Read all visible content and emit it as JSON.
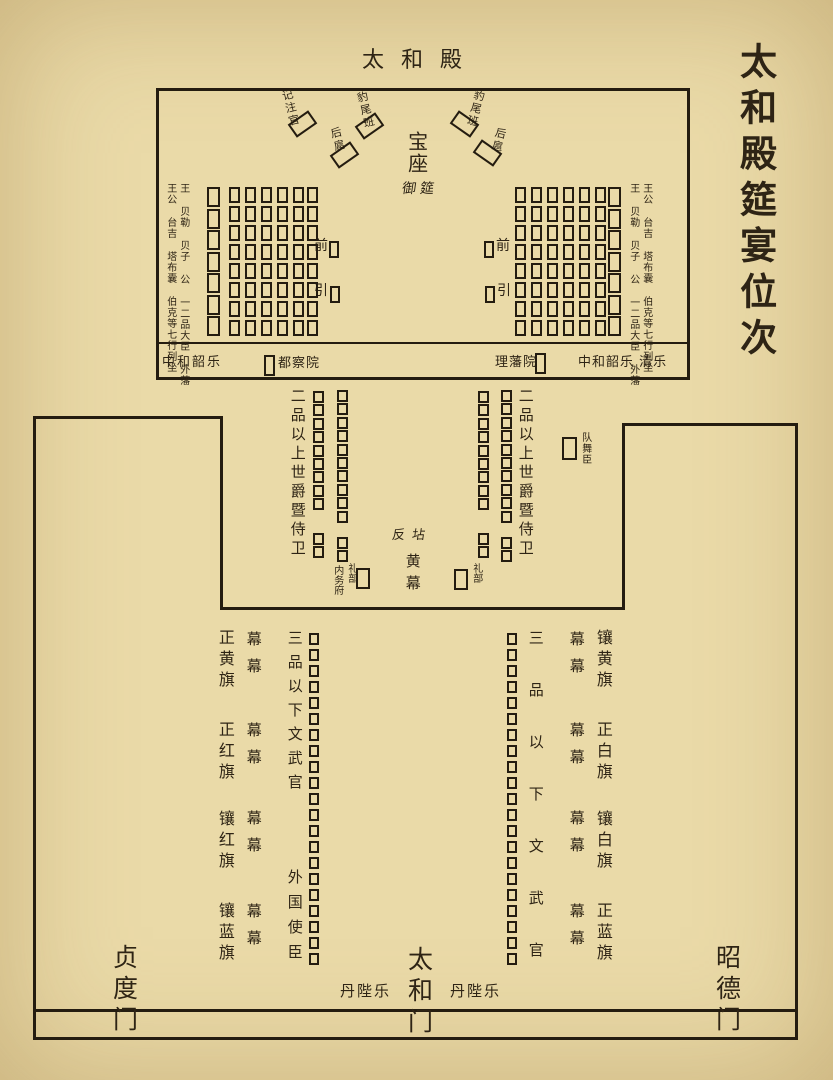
{
  "title": "太和殿筵宴位次",
  "hall": {
    "name": "太和殿",
    "throne": "宝座",
    "imperial_banquet": "御筵",
    "recorder": "记注官",
    "leopard_tail_left": "豹尾班",
    "leopard_tail_right": "豹尾班",
    "rear_escort_left": "后扈",
    "rear_escort_right": "后扈",
    "front_left": "前",
    "guide_left": "引",
    "front_right": "前",
    "guide_right": "引",
    "left_outer_label": "王公 台吉 塔布囊 伯克等七行列坐",
    "left_inner_label": "王 贝勒 贝子 公 一二品大臣 外藩",
    "right_inner_label": "王 贝勒 贝子 公 一二品大臣 外藩",
    "right_outer_label": "王公 台吉 塔布囊 伯克等七行列坐",
    "strip": {
      "music_left": "中和韶乐",
      "censorate": "都察院",
      "court_of_dependencies": "理藩院",
      "music_right": "中和韶乐 清乐"
    }
  },
  "terrace": {
    "left_label": "二品以上世爵暨侍卫",
    "right_label": "二品以上世爵暨侍卫",
    "dance_troupe": "队舞臣",
    "fandian": "反坫",
    "yellow_tent": "黄幕",
    "imperial_household_dept": "内务府",
    "rites_left": "礼部",
    "rites_right": "礼部"
  },
  "courtyard": {
    "left_banners": [
      "正黄旗",
      "正红旗",
      "镶红旗",
      "镶蓝旗"
    ],
    "right_banners": [
      "镶黄旗",
      "正白旗",
      "镶白旗",
      "正蓝旗"
    ],
    "tent_pair": "幕幕",
    "left_officials": "三品以下文武官",
    "foreign_envoys": "外国使臣",
    "right_officials": "三品以下文武官",
    "music_left": "丹陛乐",
    "music_right": "丹陛乐"
  },
  "gates": {
    "west": "贞度门",
    "center": "太和门",
    "east": "昭德门"
  },
  "colors": {
    "background": "#eadaa8",
    "ink": "#2e2415",
    "line": "#241c10"
  },
  "seats": [
    {
      "name": "recorder-seat",
      "x": 290,
      "y": 116,
      "w": 25,
      "h": 16,
      "rot": -35,
      "count": 1
    },
    {
      "name": "leopard-tail-seat-left",
      "x": 357,
      "y": 118,
      "w": 25,
      "h": 16,
      "rot": -35,
      "count": 1
    },
    {
      "name": "rear-escort-seat-left",
      "x": 332,
      "y": 147,
      "w": 25,
      "h": 16,
      "rot": -35,
      "count": 1
    },
    {
      "name": "leopard-tail-seat-right",
      "x": 452,
      "y": 116,
      "w": 25,
      "h": 16,
      "rot": 35,
      "count": 1
    },
    {
      "name": "rear-escort-seat-right",
      "x": 475,
      "y": 145,
      "w": 25,
      "h": 16,
      "rot": 35,
      "count": 1
    },
    {
      "name": "princes-column-left",
      "x": 207,
      "y": 187,
      "w": 13,
      "h": 20,
      "pitch": 21.5,
      "count": 7
    },
    {
      "name": "nobles-grid-left",
      "cols": [
        229,
        245,
        261,
        277,
        293,
        307
      ],
      "y": 187,
      "w": 11,
      "h": 16,
      "pitch": 19,
      "count": 8
    },
    {
      "name": "nobles-grid-right",
      "cols": [
        515,
        531,
        547,
        563,
        579,
        595
      ],
      "y": 187,
      "w": 11,
      "h": 16,
      "pitch": 19,
      "count": 8
    },
    {
      "name": "princes-column-right",
      "x": 608,
      "y": 187,
      "w": 13,
      "h": 20,
      "pitch": 21.5,
      "count": 7
    },
    {
      "name": "front-guide-seat-left",
      "x": 329,
      "y": 241,
      "w": 10,
      "h": 17,
      "count": 1
    },
    {
      "name": "front-guide-seat-left",
      "x": 330,
      "y": 286,
      "w": 10,
      "h": 17,
      "count": 1
    },
    {
      "name": "front-guide-seat-right",
      "x": 484,
      "y": 241,
      "w": 10,
      "h": 17,
      "count": 1
    },
    {
      "name": "front-guide-seat-right",
      "x": 485,
      "y": 286,
      "w": 10,
      "h": 17,
      "count": 1
    },
    {
      "name": "censorate-seat",
      "x": 264,
      "y": 355,
      "w": 11,
      "h": 21,
      "count": 1
    },
    {
      "name": "dependencies-court-seat",
      "x": 535,
      "y": 353,
      "w": 11,
      "h": 21,
      "count": 1
    },
    {
      "name": "guard-column-left",
      "x": 313,
      "y": 391,
      "w": 11,
      "h": 12,
      "pitch": 13.4,
      "groups": [
        9,
        2
      ],
      "gap": 21
    },
    {
      "name": "guard-column-left",
      "x": 337,
      "y": 390,
      "w": 11,
      "h": 12,
      "pitch": 13.4,
      "groups": [
        10,
        2
      ],
      "gap": 13
    },
    {
      "name": "guard-column-right",
      "x": 478,
      "y": 391,
      "w": 11,
      "h": 12,
      "pitch": 13.4,
      "groups": [
        9,
        2
      ],
      "gap": 21
    },
    {
      "name": "guard-column-right",
      "x": 501,
      "y": 390,
      "w": 11,
      "h": 12,
      "pitch": 13.4,
      "groups": [
        10,
        2
      ],
      "gap": 13
    },
    {
      "name": "dance-troupe-seat",
      "x": 562,
      "y": 437,
      "w": 15,
      "h": 23,
      "count": 1
    },
    {
      "name": "household-rites-seat-left",
      "x": 356,
      "y": 568,
      "w": 14,
      "h": 21,
      "count": 1
    },
    {
      "name": "rites-seat-right",
      "x": 454,
      "y": 569,
      "w": 14,
      "h": 21,
      "count": 1
    },
    {
      "name": "officials-column-left",
      "x": 309,
      "y": 633,
      "w": 10,
      "h": 12,
      "pitch": 16,
      "count": 21
    },
    {
      "name": "officials-column-right",
      "x": 507,
      "y": 633,
      "w": 10,
      "h": 12,
      "pitch": 16,
      "count": 21
    }
  ]
}
